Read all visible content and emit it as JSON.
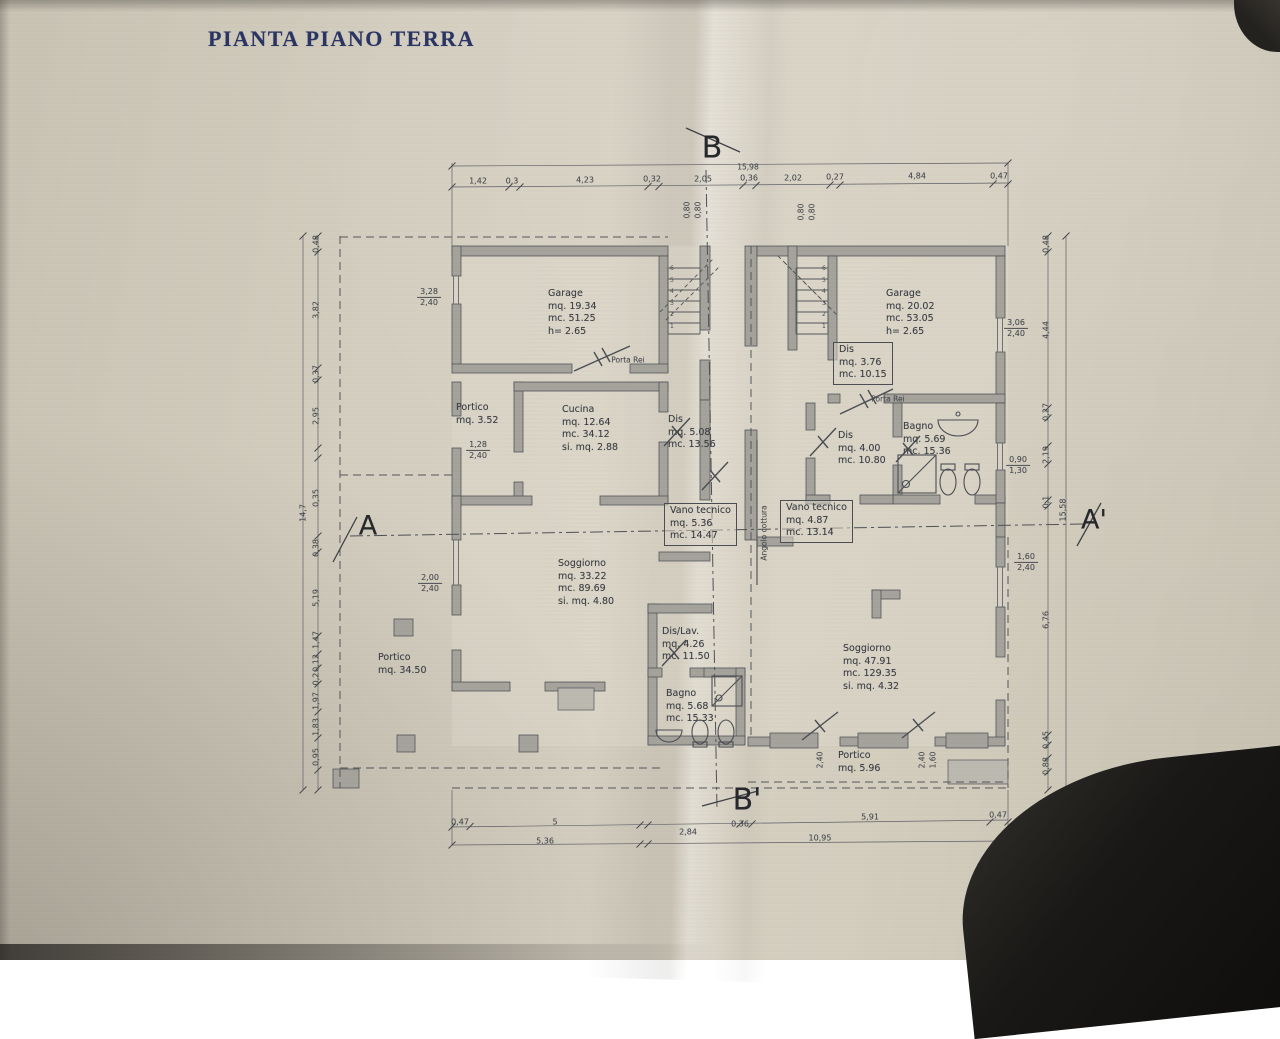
{
  "title": "PIANTA PIANO TERRA",
  "colors": {
    "paper": "#d6d0c2",
    "ink": "#45484e",
    "wall": "#a5a39b",
    "title_blue": "#2b3563"
  },
  "sections": {
    "top": "B",
    "bottom": "B'",
    "left": "A",
    "right": "A'"
  },
  "totals": {
    "top": "15,98",
    "right": "15,58",
    "left": "14,7",
    "bottom_left": "5,36",
    "bottom_right": "10,95"
  },
  "dims": {
    "top": [
      "1,42",
      "0,3",
      "4,23",
      "0,32",
      "2,05",
      "0,36",
      "2,02",
      "0,27",
      "4,84",
      "0,47"
    ],
    "bottom": [
      "0,47",
      "5",
      "2,84",
      "0,36",
      "5,91",
      "0,47"
    ],
    "left": [
      "0,48",
      "3,82",
      "0,37",
      "2,95",
      "0,35",
      "0,38",
      "5,19",
      "1,47",
      "0,12",
      "0,2",
      "1,97",
      "1,83",
      "0,95"
    ],
    "right": [
      "0,48",
      "4,44",
      "0,27",
      "2,19",
      "0,1",
      "6,76",
      "0,45",
      "0,88"
    ],
    "stair_left": [
      "0,80",
      "0,80"
    ],
    "stair_right": [
      "0,80",
      "0,80"
    ],
    "portico_bottom": [
      "2,40",
      "2,40",
      "1,60"
    ]
  },
  "fracs": {
    "garage_left_window": {
      "a": "3,28",
      "b": "2,40"
    },
    "portico_left": {
      "a": "1,28",
      "b": "2,40"
    },
    "soggiorno_left_window": {
      "a": "2,00",
      "b": "2,40"
    },
    "garage_right_window": {
      "a": "3,06",
      "b": "2,40"
    },
    "bagno_right_window": {
      "a": "0,90",
      "b": "1,30"
    },
    "soggiorno_right_window": {
      "a": "1,60",
      "b": "2,40"
    }
  },
  "rooms": {
    "garage_left": {
      "name": "Garage",
      "l1": "mq. 19.34",
      "l2": "mc. 51.25",
      "l3": "h=   2.65"
    },
    "garage_right": {
      "name": "Garage",
      "l1": "mq. 20.02",
      "l2": "mc. 53.05",
      "l3": "h=   2.65"
    },
    "portico_small": {
      "name": "Portico",
      "l1": "mq. 3.52"
    },
    "cucina": {
      "name": "Cucina",
      "l1": "mq. 12.64",
      "l2": "mc. 34.12",
      "l3": "si. mq. 2.88"
    },
    "dis_left": {
      "name": "Dis",
      "l1": "mq. 5.08",
      "l2": "mc. 13.56"
    },
    "dis_box_right": {
      "name": "Dis",
      "l1": "mq. 3.76",
      "l2": "mc. 10.15"
    },
    "dis_right": {
      "name": "Dis",
      "l1": "mq. 4.00",
      "l2": "mc. 10.80"
    },
    "bagno_right": {
      "name": "Bagno",
      "l1": "mq. 5.69",
      "l2": "mc. 15.36"
    },
    "vano_left": {
      "name": "Vano tecnico",
      "l1": "mq. 5.36",
      "l2": "mc. 14.47"
    },
    "vano_right": {
      "name": "Vano tecnico",
      "l1": "mq. 4.87",
      "l2": "mc. 13.14"
    },
    "soggiorno_left": {
      "name": "Soggiorno",
      "l1": "mq. 33.22",
      "l2": "mc. 89.69",
      "l3": "si. mq. 4.80"
    },
    "soggiorno_right": {
      "name": "Soggiorno",
      "l1": "mq. 47.91",
      "l2": "mc. 129.35",
      "l3": "si. mq. 4.32"
    },
    "dislav": {
      "name": "Dis/Lav.",
      "l1": "mq. 4.26",
      "l2": "mc. 11.50"
    },
    "bagno_left": {
      "name": "Bagno",
      "l1": "mq. 5.68",
      "l2": "mc. 15.33"
    },
    "portico_big": {
      "name": "Portico",
      "l1": "mq. 34.50"
    },
    "portico_right": {
      "name": "Portico",
      "l1": "mq. 5.96"
    }
  },
  "annotations": {
    "porta_rei_left": "Porta Rei",
    "porta_rei_right": "Porta Rei",
    "angolo_cottura": "Angolo cottura"
  },
  "stairs": {
    "left_steps": [
      "6",
      "5",
      "4",
      "3",
      "2",
      "1"
    ],
    "right_steps": [
      "6",
      "5",
      "4",
      "3",
      "2",
      "1"
    ]
  }
}
